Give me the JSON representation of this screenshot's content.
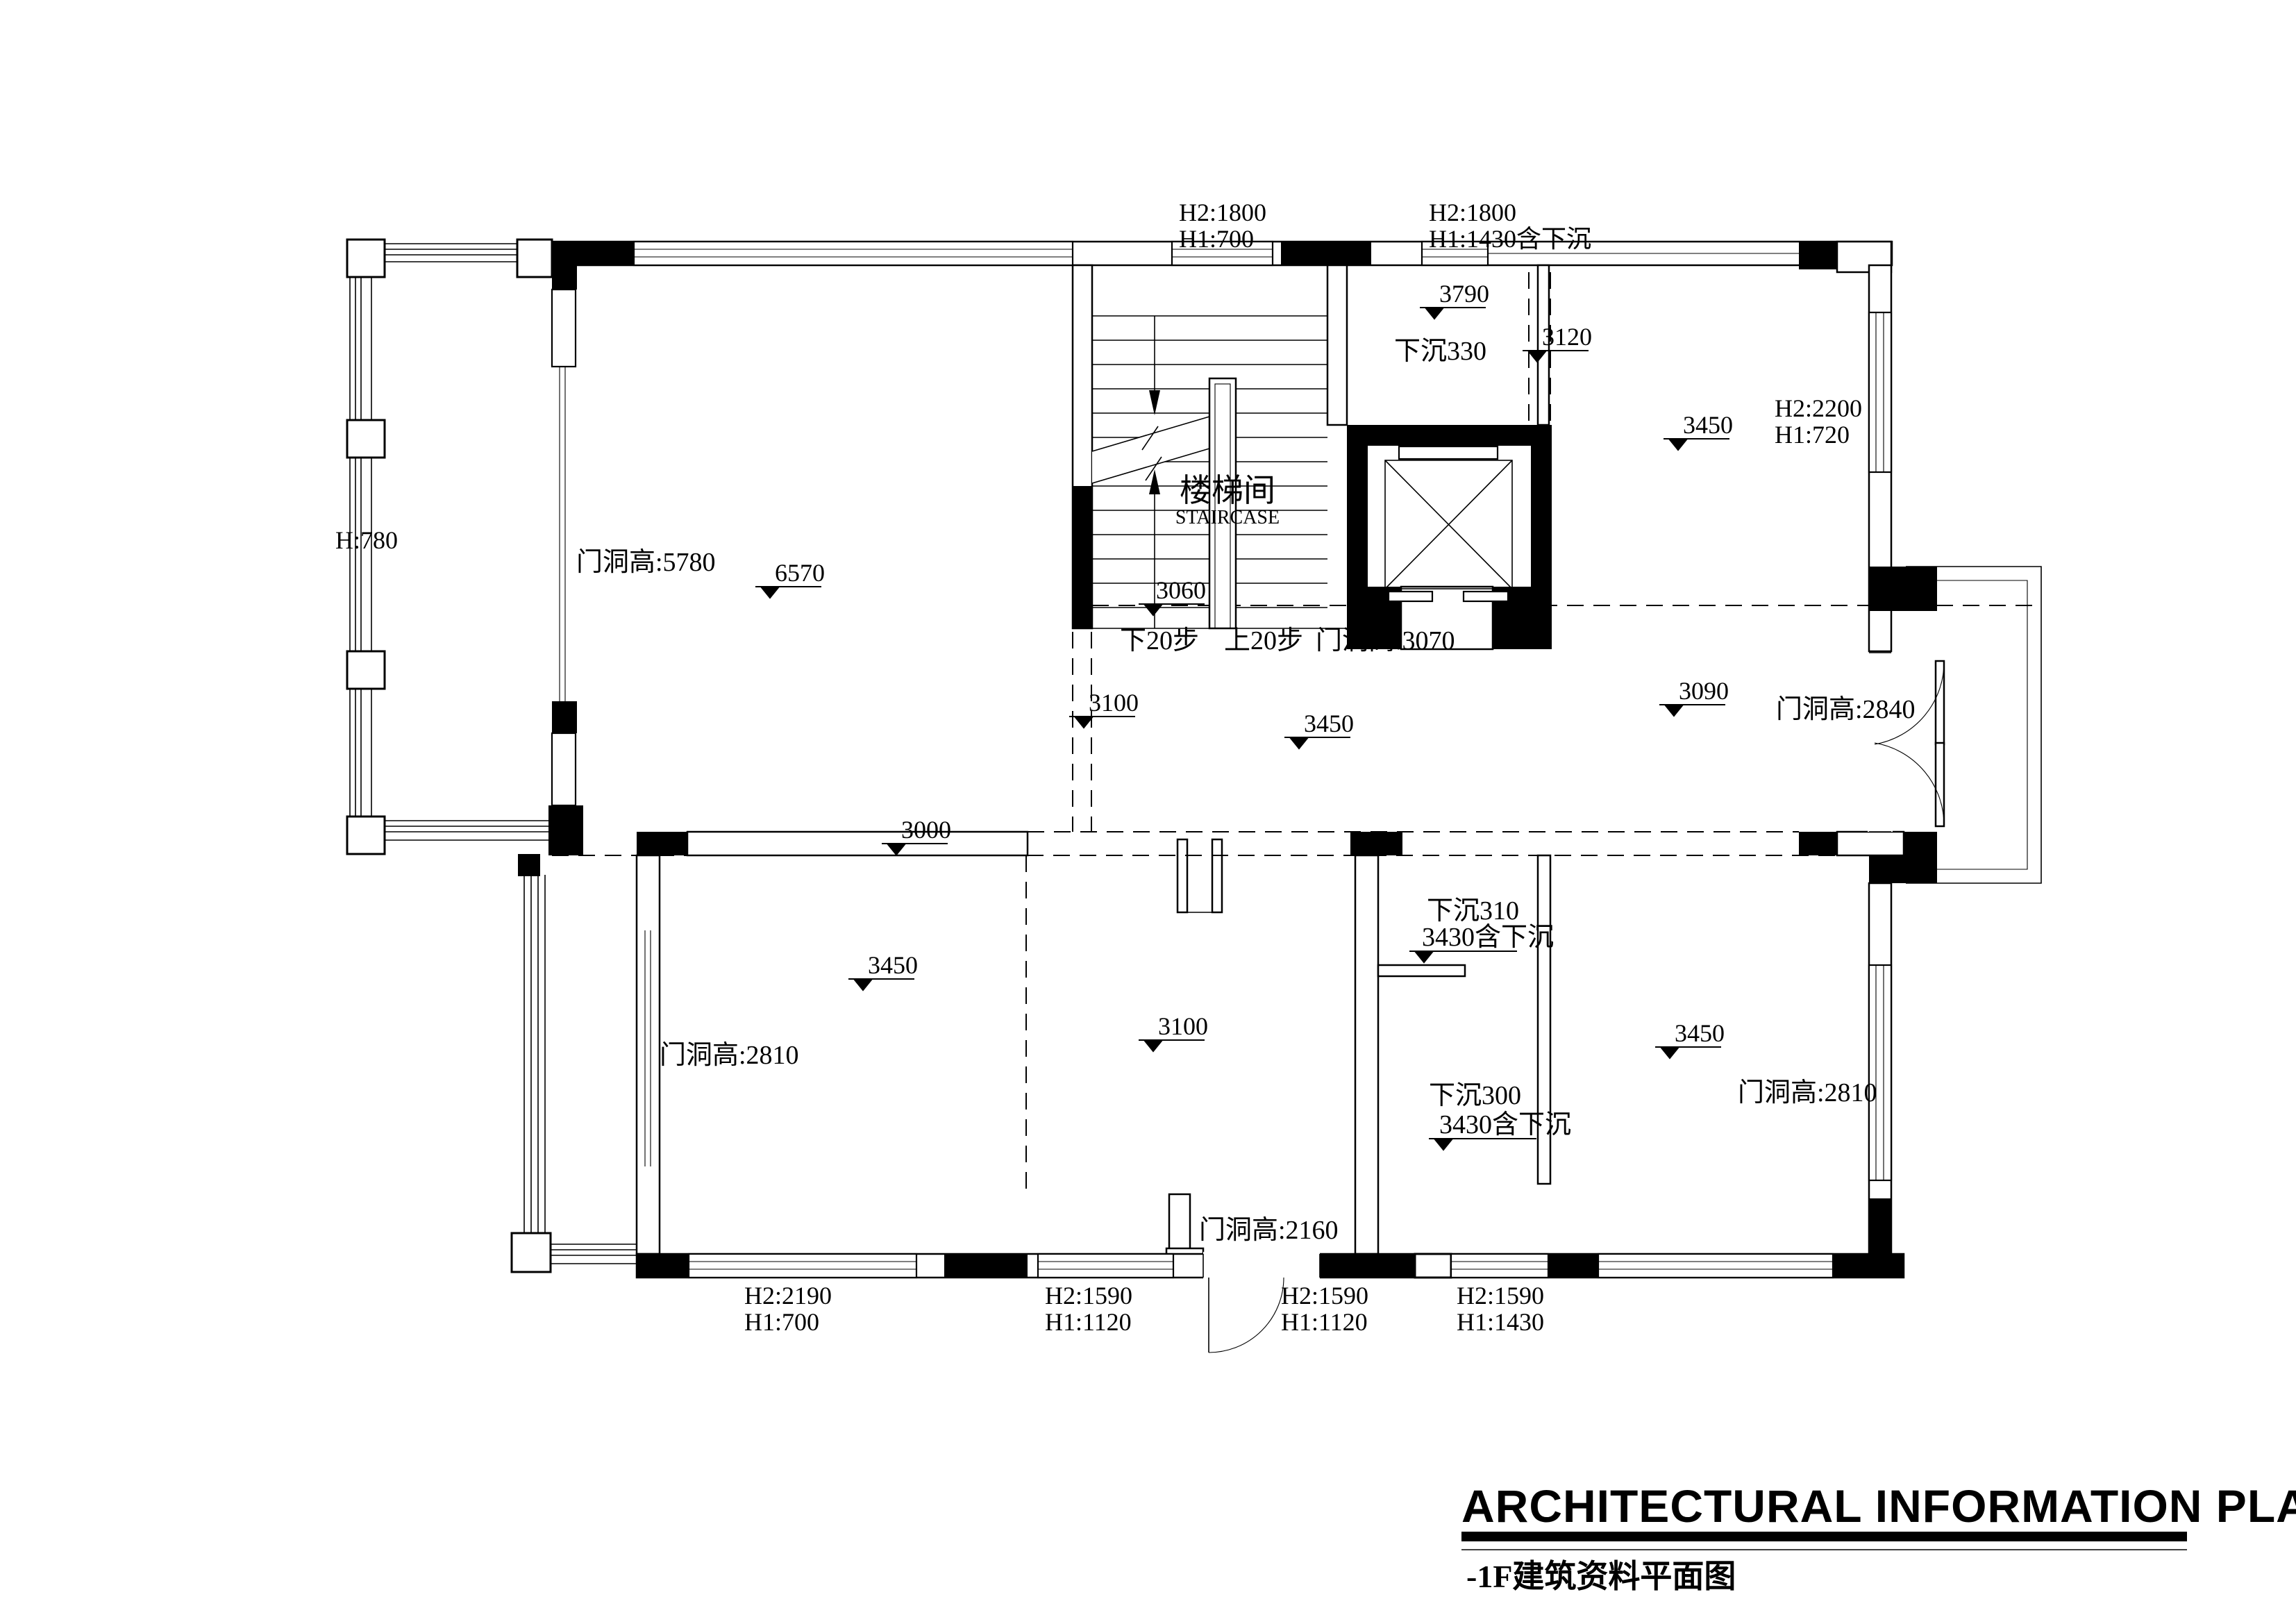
{
  "title": {
    "main": "ARCHITECTURAL INFORMATION PLAN",
    "sub": "-1F建筑资料平面图"
  },
  "staircase": {
    "name_zh": "楼梯间",
    "name_en": "STAIRCASE",
    "down_steps": "下20步",
    "up_steps": "上20步"
  },
  "window_labels": {
    "top_left": {
      "l1": "H2:1800",
      "l2": "H1:700"
    },
    "top_right": {
      "l1": "H2:1800",
      "l2": "H1:1430含下沉"
    },
    "right_upper": {
      "l1": "H2:2200",
      "l2": "H1:720"
    },
    "bottom_1": {
      "l1": "H2:2190",
      "l2": "H1:700"
    },
    "bottom_2": {
      "l1": "H2:1590",
      "l2": "H1:1120"
    },
    "bottom_3": {
      "l1": "H2:1590",
      "l2": "H1:1120"
    },
    "bottom_4": {
      "l1": "H2:1590",
      "l2": "H1:1430"
    },
    "balcony_rail_height": "H:780"
  },
  "door_labels": {
    "left_tall": "门洞高:5780",
    "elevator": "门洞高:3070",
    "entry": "门洞高:2840",
    "bottom_left": "门洞高:2810",
    "bottom_right": "门洞高:2810",
    "bottom_middle": "门洞高:2160"
  },
  "sunken_labels": {
    "s330": "下沉330",
    "s310": "下沉310",
    "s300": "下沉300"
  },
  "elevations": {
    "e3790": "3790",
    "e3120": "3120",
    "e3450_tr": "3450",
    "e6570": "6570",
    "e3060": "3060",
    "e3100_hall": "3100",
    "e3450_hall": "3450",
    "e3090": "3090",
    "e3000": "3000",
    "e3430_a": "3430含下沉",
    "e3450_bl": "3450",
    "e3100_bm": "3100",
    "e3430_b": "3430含下沉",
    "e3450_br": "3450"
  },
  "colors": {
    "line": "#000000",
    "background": "#ffffff"
  }
}
